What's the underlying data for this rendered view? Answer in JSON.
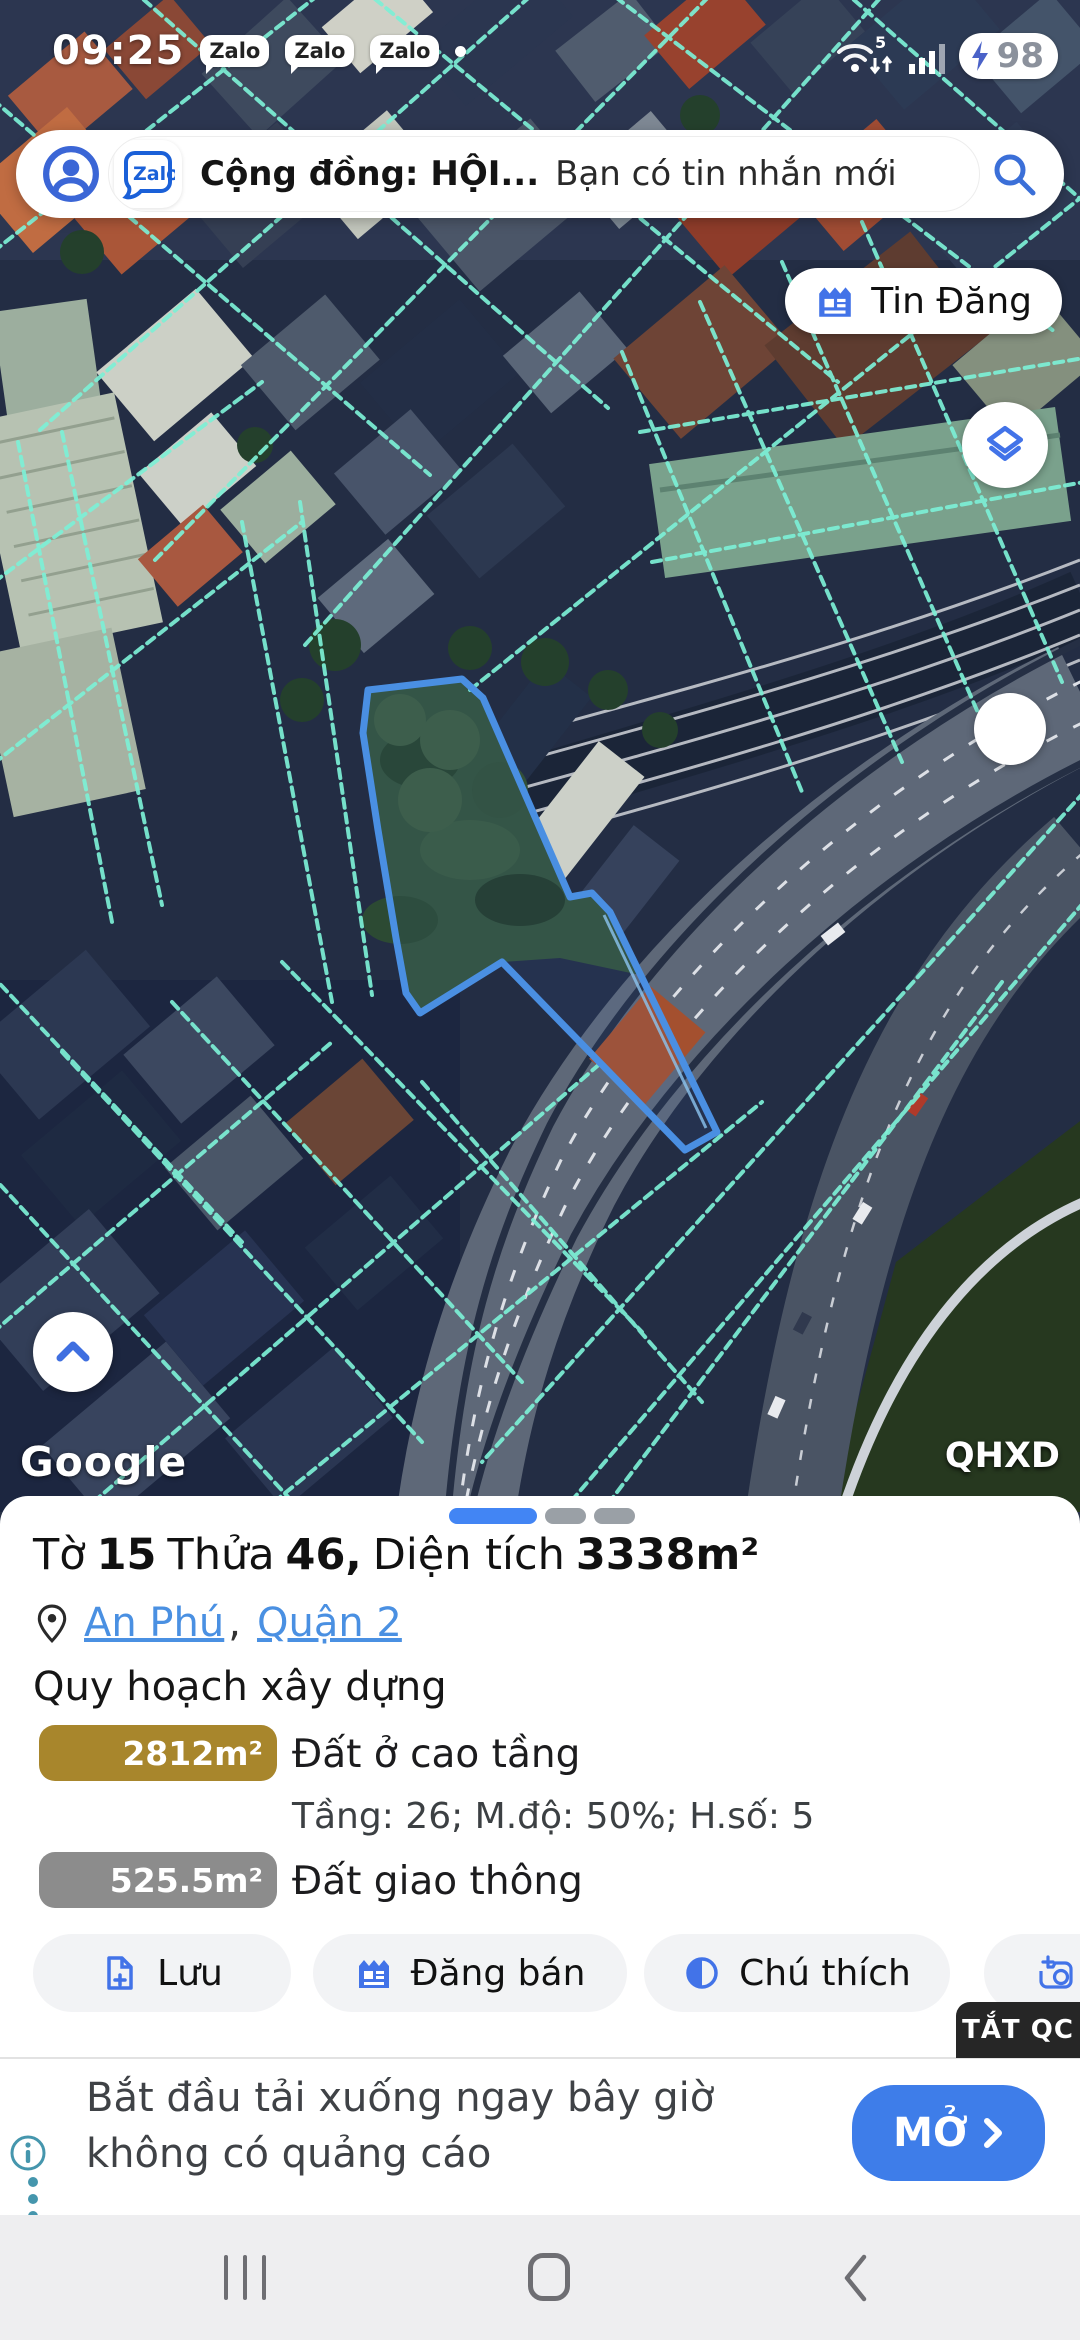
{
  "status_bar": {
    "time": "09:25",
    "zalo_badge": "Zalo",
    "wifi_speed": "5",
    "battery_percent": "98"
  },
  "search_bar": {
    "zalo_logo": "Zalo",
    "conversation": "Cộng đồng: HỘI...",
    "preview": "Bạn có tin nhắn mới"
  },
  "map": {
    "post_button": "Tin Đăng",
    "google_watermark": "Google",
    "layer_label": "QHXD"
  },
  "parcel_panel": {
    "title": {
      "word_sheet": "Tờ",
      "sheet_no": "15",
      "word_parcel": "Thửa",
      "parcel_no": "46,",
      "word_area": "Diện tích",
      "area_value": "3338m²"
    },
    "location": {
      "ward": "An Phú",
      "separator": ",",
      "district": "Quận 2"
    },
    "section_title": "Quy hoạch xây dựng",
    "zones": [
      {
        "area": "2812m²",
        "name": "Đất ở cao tầng",
        "color": "#a8862c",
        "details": "Tầng: 26; M.độ: 50%; H.số: 5"
      },
      {
        "area": "525.5m²",
        "name": "Đất giao thông",
        "color": "#8c8c8c",
        "details": ""
      }
    ],
    "actions": {
      "save": "Lưu",
      "post_sale": "Đăng bán",
      "legend": "Chú thích"
    }
  },
  "ad_banner": {
    "dismiss": "TẮT QC",
    "line1": "Bắt đầu tải xuống ngay bây giờ",
    "line2": "không có quảng cáo",
    "cta": "MỞ"
  },
  "colors": {
    "accent_blue": "#4273e8",
    "link_blue": "#4a90e2",
    "parcel_outline": "#4a8fe2",
    "cadastral_line": "#7df0d6",
    "zone_residential": "#a8862c",
    "zone_traffic": "#8c8c8c",
    "cta_blue": "#3e7de9"
  }
}
